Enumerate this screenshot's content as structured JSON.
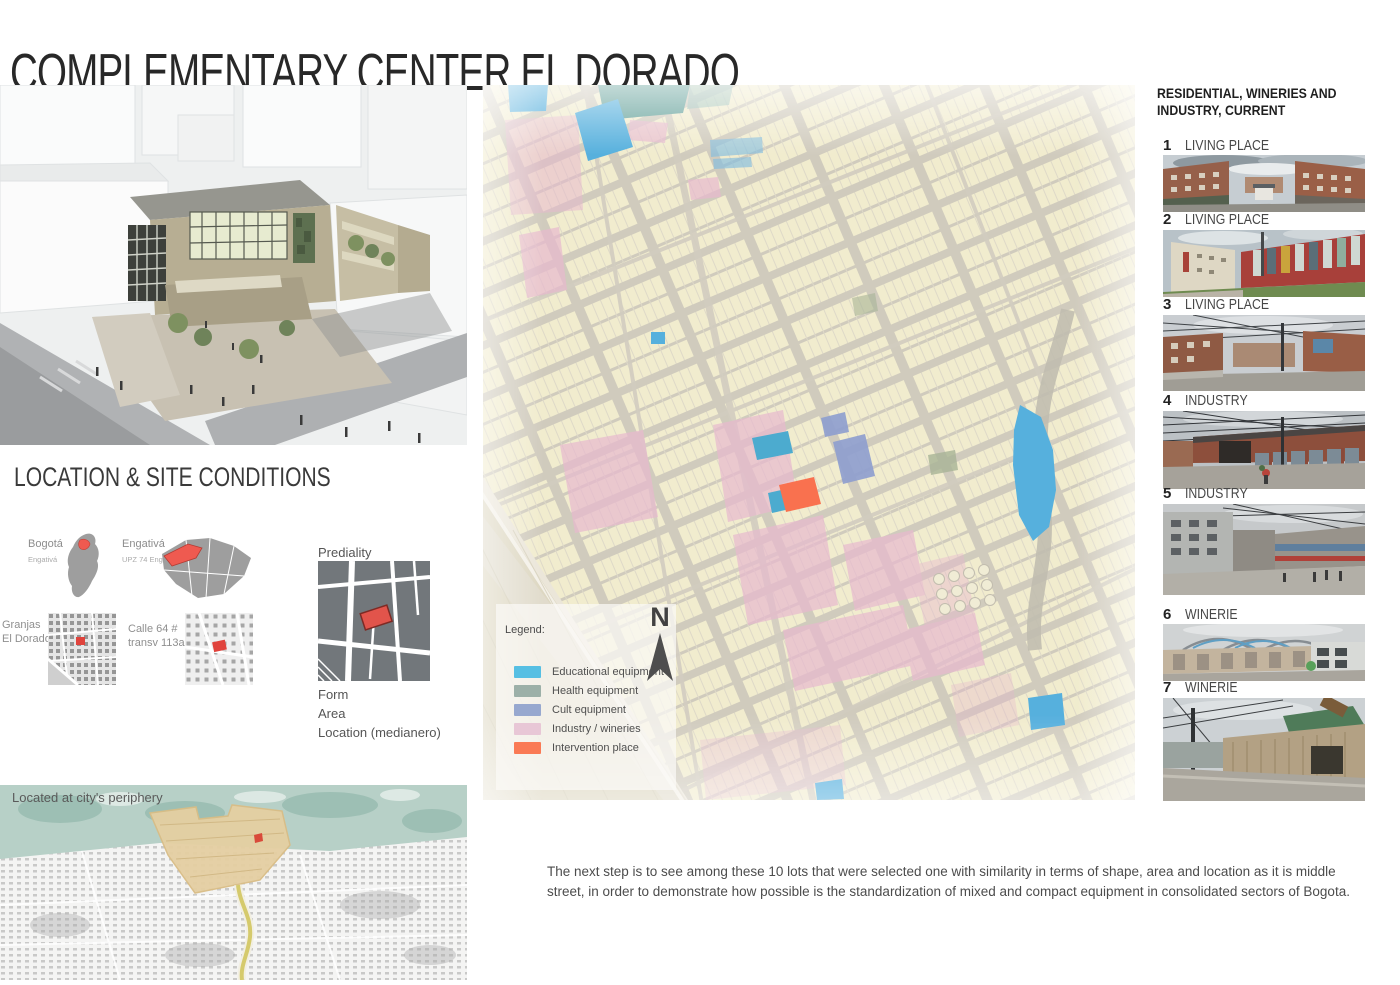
{
  "title": "COMPLEMENTARY CENTER EL DORADO",
  "location_section": {
    "heading": "LOCATION & SITE CONDITIONS",
    "maps": [
      {
        "label": "Bogotá",
        "sublabel": "Engativá"
      },
      {
        "label": "Engativá",
        "sublabel": "UPZ 74 Engativá"
      },
      {
        "label": "Granjas",
        "sublabel": "El Dorado"
      },
      {
        "label": "Calle 64 #",
        "sublabel": "transv 113a."
      }
    ],
    "prediality": {
      "title": "Prediality",
      "notes": [
        "Form",
        "Area",
        "Location (medianero)"
      ]
    }
  },
  "map": {
    "north_label": "N",
    "legend": {
      "title": "Legend:",
      "items": [
        {
          "label": "Educational equipment",
          "color": "#56bfe3"
        },
        {
          "label": "Health equipment",
          "color": "#9cb0a8"
        },
        {
          "label": "Cult equipment",
          "color": "#97a8cf"
        },
        {
          "label": "Industry / wineries",
          "color": "#e8c7d6"
        },
        {
          "label": "Intervention place",
          "color": "#fa7a55"
        }
      ]
    }
  },
  "right_column": {
    "heading_line1": "RESIDENTIAL, WINERIES AND",
    "heading_line2": "INDUSTRY, CURRENT",
    "items": [
      {
        "number": "1",
        "label": "LIVING PLACE"
      },
      {
        "number": "2",
        "label": "LIVING PLACE"
      },
      {
        "number": "3",
        "label": "LIVING PLACE"
      },
      {
        "number": "4",
        "label": "INDUSTRY"
      },
      {
        "number": "5",
        "label": "INDUSTRY"
      },
      {
        "number": "6",
        "label": "WINERIE"
      },
      {
        "number": "7",
        "label": "WINERIE"
      }
    ]
  },
  "periphery": {
    "caption": "Located at city's periphery"
  },
  "footer_text": "The next step is to see among these 10 lots that were selected one with similarity in terms of shape, area and location as it is middle street, in order to demonstrate how possible is the standardization of mixed and compact equipment in consolidated sectors of Bogota."
}
